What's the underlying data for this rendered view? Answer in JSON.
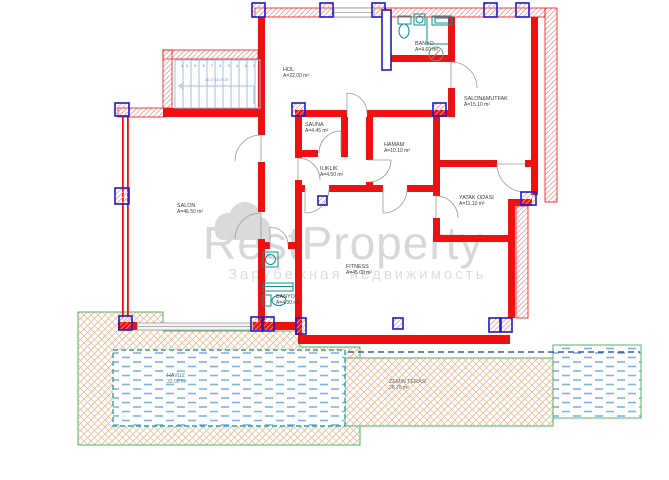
{
  "document": {
    "type": "architectural floor plan",
    "floor": "ground floor villa plan"
  },
  "watermark": {
    "brand": "RestProperty",
    "subtitle": "Зарубежная недвижимость",
    "logo": "cloud-logo"
  },
  "rooms": [
    {
      "id": "hol",
      "name": "HOL",
      "area": "A=22.00 m²"
    },
    {
      "id": "banyo-ust",
      "name": "BANYO",
      "area": "A=4.60 m²"
    },
    {
      "id": "salon-mutfak",
      "name": "SALON&MUTFAK",
      "area": "A=15.10 m²"
    },
    {
      "id": "sauna",
      "name": "SAUNA",
      "area": "A=4.45 m²"
    },
    {
      "id": "hamam",
      "name": "HAMAM",
      "area": "A=10.10 m²"
    },
    {
      "id": "iliklik",
      "name": "ILIKLIK",
      "area": "A=4.50 m²"
    },
    {
      "id": "yatak-odasi",
      "name": "YATAK ODASI",
      "area": "A=11.10 m²"
    },
    {
      "id": "salon",
      "name": "SALON",
      "area": "A=46.50 m²"
    },
    {
      "id": "fitness",
      "name": "FITNESS",
      "area": "A=45.00 m²"
    },
    {
      "id": "banyo-alt",
      "name": "BANYO",
      "area": "A=4.30 m²"
    }
  ],
  "outdoor": [
    {
      "id": "havuz",
      "name": "HAVUZ",
      "area": "32.00 m²"
    },
    {
      "id": "zemin-terasi",
      "name": "ZEMIN TERASI",
      "area": "36.70 m²"
    }
  ],
  "stairs": {
    "numbers": "10 9 8 7 6 5 4 3 2",
    "mid_numbers": "16 17 18 19 20"
  },
  "colors": {
    "wall_red": "#ee1111",
    "column_blue": "#1c1ccc",
    "exterior_hatch_pink": "#f59b9b",
    "stair_blue": "#9cc3e8",
    "fixture_teal": "#0e8f8f",
    "water_blue": "#7fb3e6",
    "terrace_orange": "#e7a97e",
    "landscape_green": "#53b363",
    "pool_border_teal": "#2ea3a3",
    "door_gray": "#9a9a9a",
    "watermark_gray": "#d8d8d8"
  }
}
